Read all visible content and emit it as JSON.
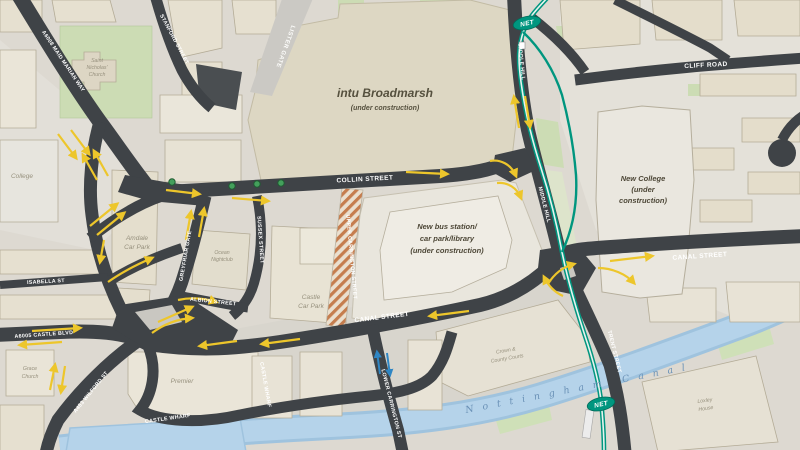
{
  "map": {
    "type": "street-map-construction-plan",
    "colors": {
      "road": "#3f4347",
      "arrow_yellow": "#edc62b",
      "arrow_blue": "#2f86c4",
      "tram_teal": "#00967f",
      "canal_blue": "#b5d3ea",
      "construction_hatch": "#c57d4e",
      "land": "#ddd9d1",
      "building": "#e6e0d0",
      "green": "#cddcb3"
    },
    "construction_sites": {
      "broadmarsh": {
        "name": "intu Broadmarsh",
        "status": "(under construction)"
      },
      "bus_station": {
        "line1": "New bus station/",
        "line2": "car park/library",
        "line3": "(under construction)"
      },
      "new_college": {
        "line1": "New College",
        "line2": "(under",
        "line3": "construction)"
      }
    },
    "streets": {
      "maid_marian_way": "A6008 MAID MARIAN WAY",
      "stanford_street": "STANFORD STREET",
      "lister_gate": "LISTER GATE",
      "collin_street": "COLLIN STREET",
      "middle_hill_upper": "MIDDLE HILL",
      "middle_hill_lower": "MIDDLE HILL",
      "cliff_road": "CLIFF ROAD",
      "canal_street_west": "CANAL STREET",
      "canal_street_east": "CANAL STREET",
      "greyfriar_gate": "GREYFRIAR GATE",
      "sussex_street": "SUSSEX STREET",
      "albion_street": "ALBION STREET",
      "upper_carrington_street": "UPPER CARRINGTON STREET",
      "lower_carrington_st": "LOWER CARRINGTON ST",
      "trent_street": "TRENT STREET",
      "castle_blvd": "A6005 CASTLE BLVD",
      "wilford_st": "A453 WILFORD ST",
      "isabella_st": "ISABELLA ST",
      "castle_wharf": "CASTLE WHARF",
      "castle_wharf_vertical": "CASTLE WHARF"
    },
    "places": {
      "st_nicholas_line1": "Saint",
      "st_nicholas_line2": "Nicholas'",
      "st_nicholas_line3": "Church",
      "college": "College",
      "amdale_line1": "Amdale",
      "amdale_line2": "Car Park",
      "ocean_line1": "Ocean",
      "ocean_line2": "Nightclub",
      "castle_cp_line1": "Castle",
      "castle_cp_line2": "Car Park",
      "courts_line1": "Crown &",
      "courts_line2": "County Courts",
      "premier": "Premier",
      "grace_line1": "Grace",
      "grace_line2": "Church",
      "loxley_line1": "Loxley",
      "loxley_line2": "House",
      "nottingham_canal": "Nottingham  Canal"
    },
    "transit": {
      "net_badge_top": "NET",
      "net_badge_bottom": "NET"
    }
  }
}
